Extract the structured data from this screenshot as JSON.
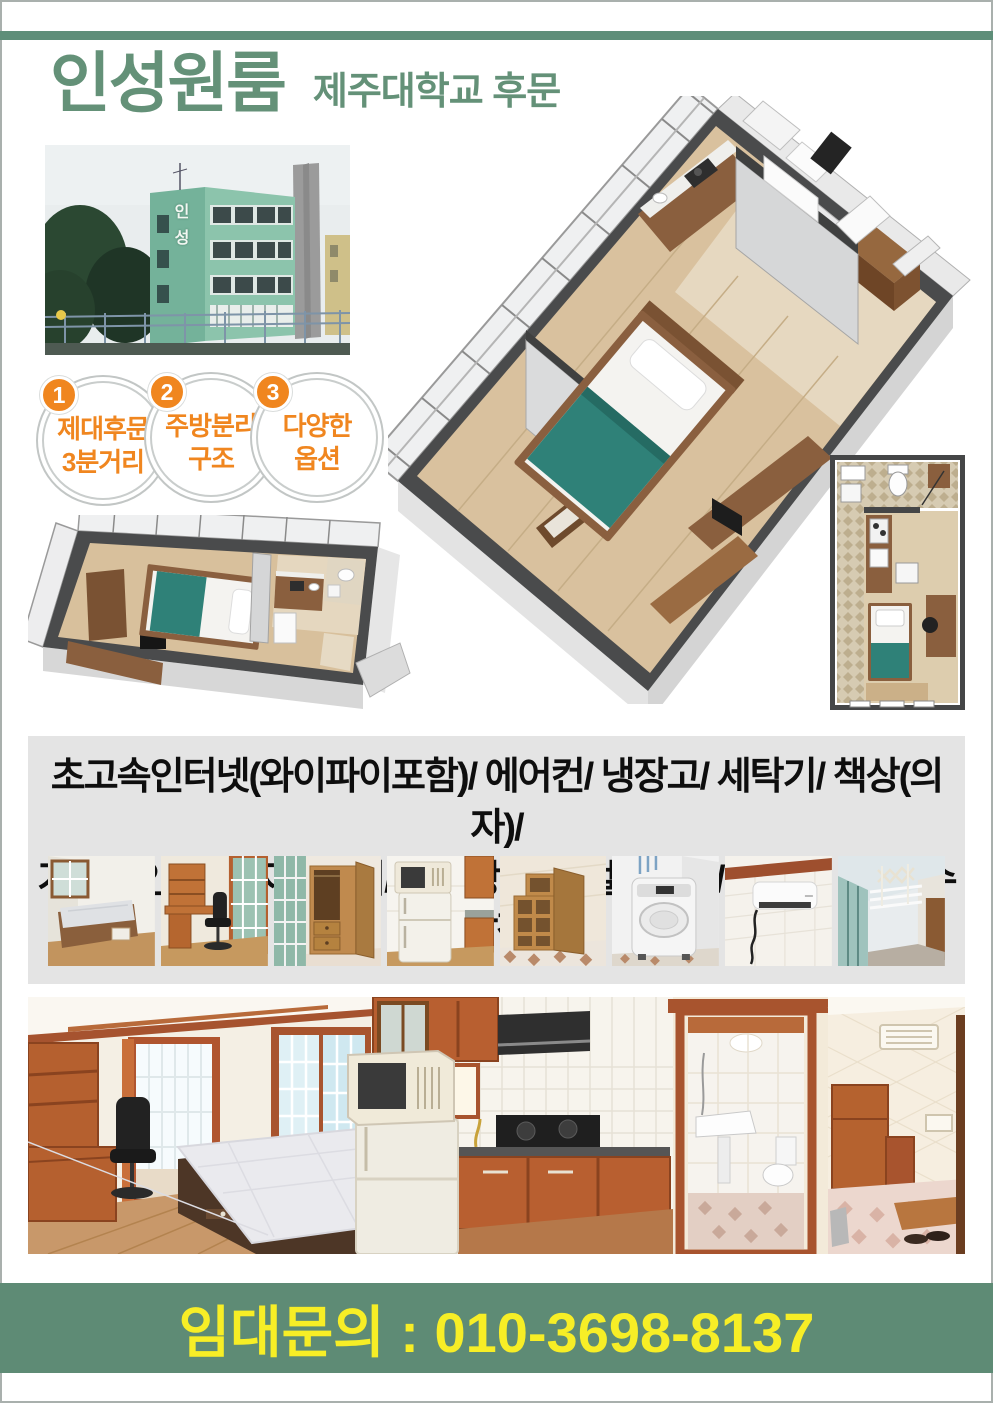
{
  "header": {
    "title": "인성원룸",
    "subtitle": "제주대학교 후문"
  },
  "building_photo": {
    "sign": "인성"
  },
  "features": [
    {
      "num": "1",
      "line1": "제대후문",
      "line2": "3분거리"
    },
    {
      "num": "2",
      "line1": "주방분리",
      "line2": "구조"
    },
    {
      "num": "3",
      "line1": "다양한",
      "line2": "옵션"
    }
  ],
  "amenities": {
    "line1": "초고속인터넷(와이파이포함)/ 에어컨/ 냉장고/ 세탁기/ 책상(의자)/",
    "line2": "가스레인지/ 전자레인지/ 신발장/ 디지털도어락/ 서랍형 침대/ 수납장"
  },
  "gallery": {
    "items": [
      "bed-photo",
      "desk-photo",
      "wardrobe-photo",
      "fridge-microwave-photo",
      "shelf-photo",
      "washing-machine-photo",
      "air-conditioner-photo",
      "drying-rack-photo"
    ]
  },
  "contact": {
    "text": "임대문의 : 010-3698-8137"
  },
  "colors": {
    "accent_green": "#5E8E79",
    "title_green": "#649178",
    "accent_orange": "#F0861F",
    "highlight_yellow": "#F7EE26",
    "box_gray": "#E4E4E4"
  }
}
